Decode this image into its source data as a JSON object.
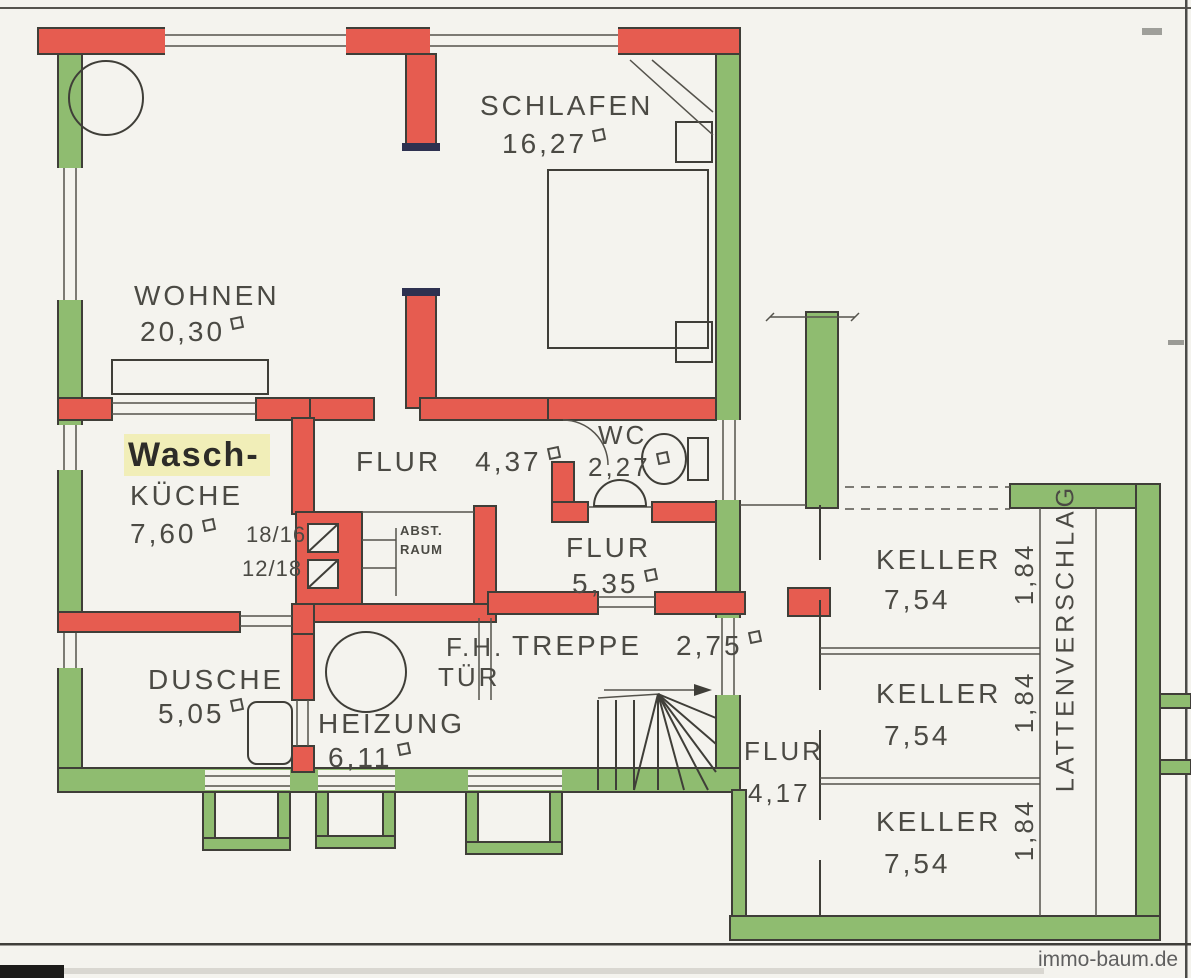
{
  "page": {
    "watermark": "immo-baum.de"
  },
  "colors": {
    "paper": "#f4f3ee",
    "outer_wall_green": "#8fbc70",
    "inner_wall_red": "#e65c50",
    "cap_dark": "#2e3150",
    "highlight": "#f1eeb8",
    "ink": "#4b4a44"
  },
  "labels": {
    "schlafen": {
      "name": "SCHLAFEN",
      "area": "16,27"
    },
    "wohnen": {
      "name": "WOHNEN",
      "area": "20,30"
    },
    "waschkueche": {
      "prefix": "Wasch-",
      "name": "KÜCHE",
      "area": "7,60"
    },
    "chimney": {
      "dim_top": "18/16",
      "dim_bottom": "12/18"
    },
    "flur_og": {
      "name": "FLUR",
      "area": "4,37"
    },
    "wc": {
      "name": "WC",
      "area": "2,27"
    },
    "abstellraum": {
      "line1": "ABST.",
      "line2": "RAUM"
    },
    "flur_mitte": {
      "name": "FLUR",
      "area": "5,35"
    },
    "dusche": {
      "name": "DUSCHE",
      "area": "5,05"
    },
    "heizung": {
      "name": "HEIZUNG",
      "area": "6,11"
    },
    "fh_tuer": {
      "line1": "F.H.",
      "line2": "TÜR"
    },
    "treppe": {
      "name": "TREPPE",
      "area": "2,75"
    },
    "flur_keller": {
      "name": "FLUR",
      "area": "4,17"
    },
    "keller_top": {
      "name": "KELLER",
      "area": "7,54",
      "depth": "1,84"
    },
    "keller_mitte": {
      "name": "KELLER",
      "area": "7,54",
      "depth": "1,84"
    },
    "keller_unten": {
      "name": "KELLER",
      "area": "7,54",
      "depth": "1,84"
    },
    "lattenverschlag": "LATTENVERSCHLAG"
  }
}
